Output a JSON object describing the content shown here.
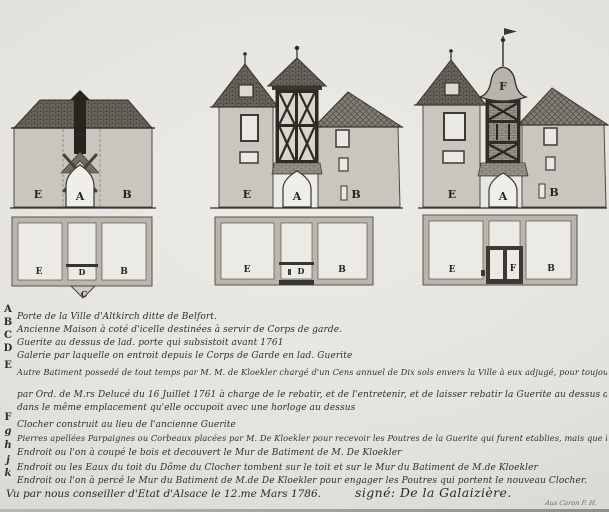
{
  "colors": {
    "paper": "#e4e2dd",
    "ink": "#2f2e29",
    "wall": "#c8c6bf",
    "roof_dark": "#5a574f",
    "plan_wall": "#b9b6ad"
  },
  "drawings": {
    "elev_left": {
      "left": "E",
      "arch": "A",
      "right": "B"
    },
    "plan_left": {
      "left": "E",
      "center": "D",
      "right": "B",
      "gate": "C"
    },
    "elev_mid": {
      "left": "E",
      "arch": "A",
      "right": "B"
    },
    "plan_mid": {
      "left": "E",
      "center": "D",
      "right": "B"
    },
    "elev_right": {
      "left": "E",
      "arch": "A",
      "right": "B",
      "dome": "F"
    },
    "plan_right": {
      "left": "E",
      "center": "F",
      "right": "B"
    }
  },
  "legend": {
    "entries": [
      {
        "key": "A",
        "lines": [
          "Porte de la Ville d'Altkirch ditte de Belfort."
        ]
      },
      {
        "key": "B",
        "lines": [
          "Ancienne Maison à coté d'icelle destinées à servir de Corps de garde."
        ]
      },
      {
        "key": "C",
        "lines": [
          "Guerite au dessus de lad. porte qui subsistoit avant 1761"
        ]
      },
      {
        "key": "D",
        "lines": [
          "Galerie par laquelle on entroit depuis le Corps de Garde en lad. Guerite"
        ]
      },
      {
        "key": "E",
        "lines": [
          "Autre Batiment possedé de tout temps par M. M. de Kloekler chargé d'un Cens annuel de Dix sols envers la Ville à eux adjugé, pour toujours",
          "par Ord. de M.rs Delucé du 16 Juillet 1761 à charge de le rebatir, et de l'entretenir, et de laisser rebatir la Guerite au dessus de la Porte",
          "dans le même emplacement qu'elle occupoit avec une horloge au dessus"
        ]
      },
      {
        "key": "F",
        "lines": [
          "Clocher construit au lieu de l'ancienne Guerite"
        ]
      },
      {
        "key": "g",
        "lines": [
          "Pierres apellées Parpaignes ou Corbeaux placées par M. De Kloekler pour recevoir les Poutres de la Guerite qui furent etablies, mais que l'on n'a pas suivies"
        ]
      },
      {
        "key": "h",
        "lines": [
          "Endroit ou l'on à coupé le bois et decouvert le Mur de Batiment de M. De Kloekler"
        ]
      },
      {
        "key": "j",
        "lines": [
          "Endroit ou les Eaux du toit du Dôme du Clocher tombent sur le toit et sur le Mur du Batiment de M.de Kloekler"
        ]
      },
      {
        "key": "k",
        "lines": [
          "Endroit ou l'on à percé le Mur du Batiment de M.de De Kloekler pour engager les Poutres qui portent le nouveau Clocher."
        ]
      }
    ],
    "attestation": "Vu par nous conseiller d'Etat d'Alsace le 12.me Mars 1786.",
    "signature": "signé: De la Galaizière.",
    "corner_note": "Aus Caron F. H."
  }
}
